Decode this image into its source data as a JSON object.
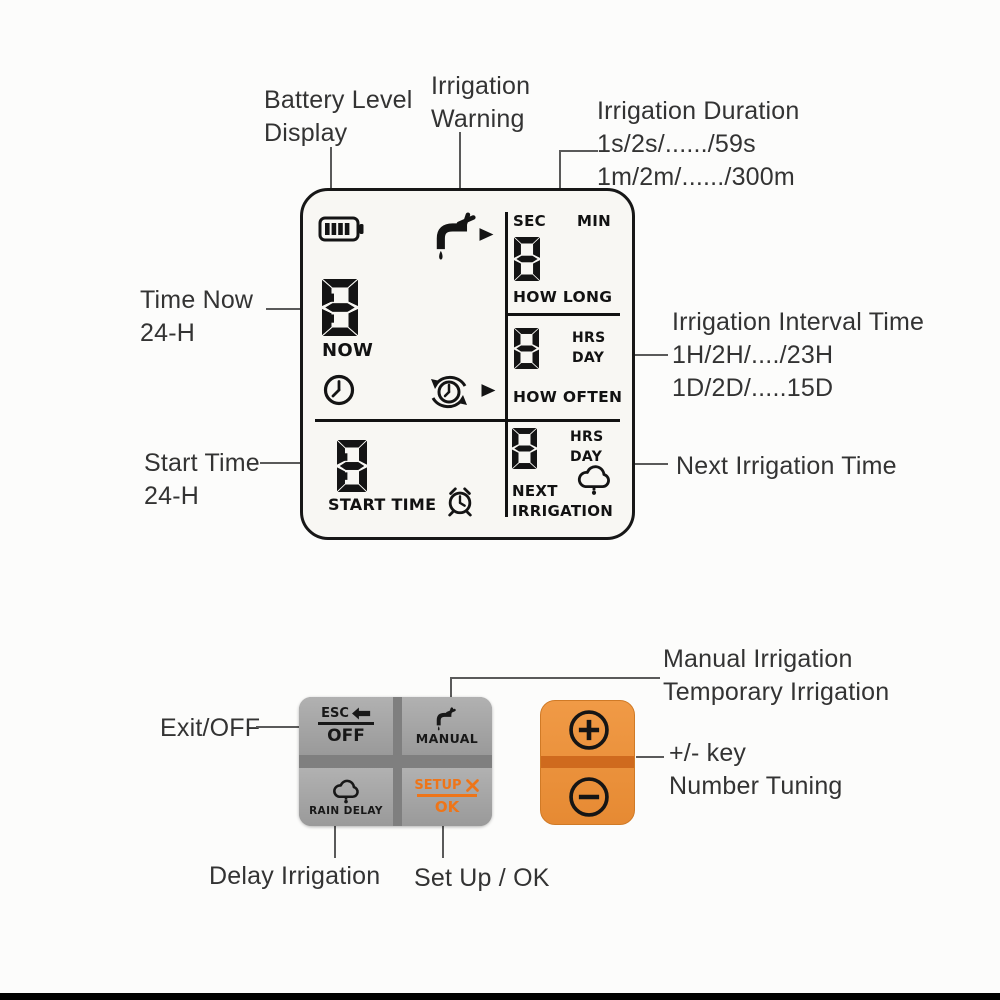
{
  "colors": {
    "label_text": "#333333",
    "annotation_line": "#5a5a5a",
    "lcd_ink": "#141414",
    "pad_sep_gray": "#7f7f7f",
    "setup_orange": "#ee7519",
    "orange_key": "#ec9340",
    "orange_band": "#cf6a1e",
    "orange_border": "#d07a26"
  },
  "labels": {
    "battery_1": "Battery Level",
    "battery_2": "Display",
    "warning_1": "Irrigation",
    "warning_2": "Warning",
    "duration_1": "Irrigation Duration",
    "duration_2": "1s/2s/....../59s",
    "duration_3": "1m/2m/....../300m",
    "time_now_1": "Time Now",
    "time_now_2": "24-H",
    "interval_1": "Irrigation Interval Time",
    "interval_2": "1H/2H/..../23H",
    "interval_3": "1D/2D/.....15D",
    "start_1": "Start Time",
    "start_2": "24-H",
    "next_irrigation": "Next Irrigation Time",
    "manual_1": "Manual Irrigation",
    "manual_2": "Temporary Irrigation",
    "plusminus_1": "+/- key",
    "plusminus_2": "Number Tuning",
    "exit": "Exit/OFF",
    "delay": "Delay Irrigation",
    "setup_ok": "Set Up / OK"
  },
  "lcd": {
    "time_now_digits": "88:88",
    "now": "NOW",
    "start_digits": "88:88",
    "start_time": "START TIME",
    "sec": "SEC",
    "min": "MIN",
    "duration_digits": "888",
    "how_long": "HOW LONG",
    "interval_digits": "88",
    "hrs1": "HRS",
    "day1": "DAY",
    "how_often": "HOW OFTEN",
    "next_digits": "88",
    "hrs2": "HRS",
    "day2": "DAY",
    "next1": "NEXT",
    "next2": "IRRIGATION"
  },
  "keypad": {
    "esc": "ESC",
    "off": "OFF",
    "manual": "MANUAL",
    "rain_delay": "RAIN DELAY",
    "setup": "SETUP",
    "ok": "OK"
  },
  "icons": {
    "battery-icon": "battery gauge with 4 bars",
    "irrigation-warning-icon": "faucet with water drop",
    "arrow-right-icon": "➤",
    "clock-icon": "clock face",
    "cycle-clock-icon": "clock with circular arrows",
    "alarm-clock-icon": "alarm clock",
    "rain-cloud-icon": "cloud with raindrop",
    "esc-arrow-icon": "⬅",
    "wrench-icon": "crossed wrench",
    "plus-icon": "⊕",
    "minus-icon": "⊖"
  }
}
